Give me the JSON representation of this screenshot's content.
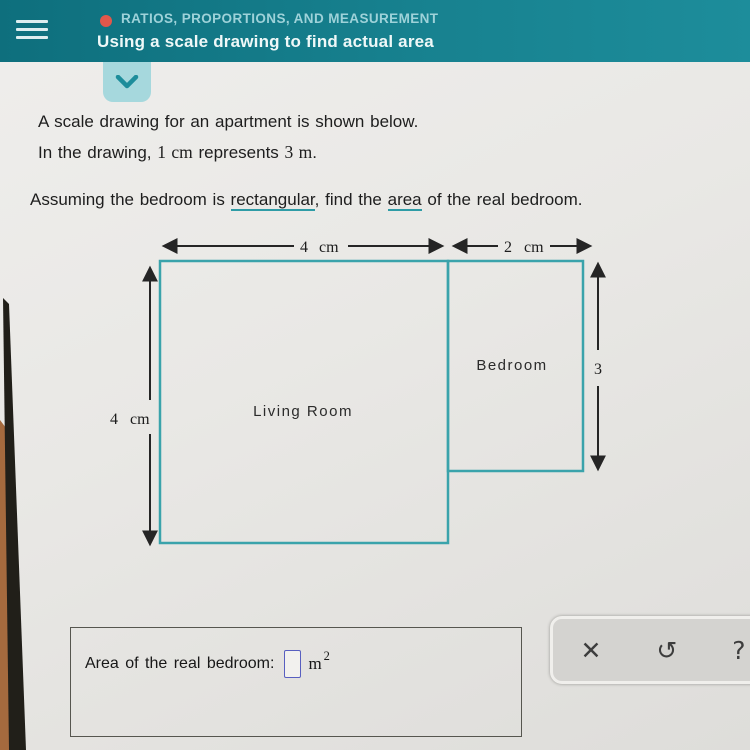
{
  "header": {
    "category": "RATIOS, PROPORTIONS, AND MEASUREMENT",
    "title": "Using a scale drawing to find actual area"
  },
  "problem": {
    "line1": "A scale drawing for an apartment is shown below.",
    "line2": [
      "In the drawing, ",
      "1 cm",
      " represents ",
      "3 m",
      "."
    ],
    "line3": [
      "Assuming the bedroom is ",
      "rectangular",
      ", find the ",
      "area",
      " of the real bedroom."
    ]
  },
  "diagram": {
    "living_label": "Living Room",
    "bedroom_label": "Bedroom",
    "living_width": {
      "value": "4",
      "unit": "cm"
    },
    "bedroom_width": {
      "value": "2",
      "unit": "cm"
    },
    "living_height": {
      "value": "4",
      "unit": "cm"
    },
    "bedroom_height": {
      "value": "3",
      "unit": "cm"
    }
  },
  "answer": {
    "prompt": "Area of the real bedroom:",
    "input_value": "",
    "unit_base": "m",
    "unit_exponent": "2"
  },
  "toolbar": {
    "close": "✕",
    "undo": "↺",
    "help": "?"
  },
  "colors": {
    "header_teal": "#17818f",
    "chevron_button_bg": "#a6d8dd",
    "category_dot": "#e2574b",
    "diagram_border": "#3aa3ab",
    "glossary_underline": "#2e9ca6",
    "answer_input_border": "#585fc0"
  }
}
